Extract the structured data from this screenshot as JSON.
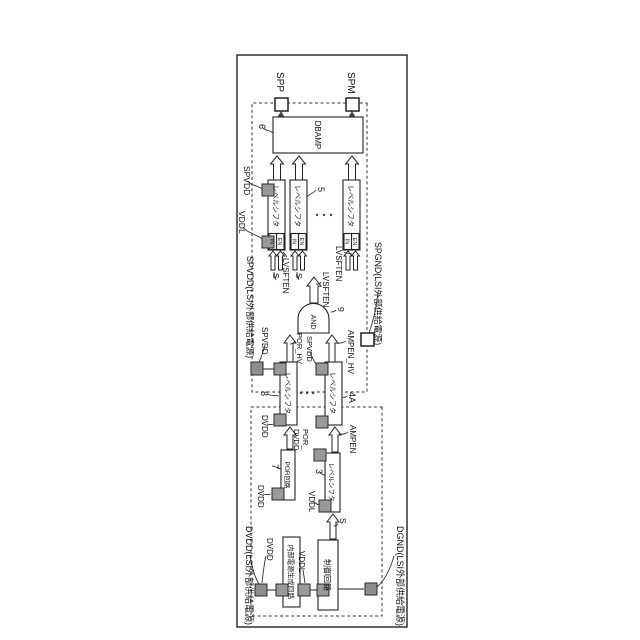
{
  "figure": {
    "outputs": {
      "spp": "SPP",
      "spm": "SPM"
    },
    "blocks": {
      "dbamp": "DBAMP",
      "level_shifter": "レベルシフタ",
      "and_gate": "AND",
      "control_circuit": "制御回路",
      "internal_power_circuit": "内部電源生成回路",
      "por_circuit": "POR回路",
      "in_pin": "IN",
      "en_pin": "EN"
    },
    "signals": {
      "s": "S",
      "lvsften": "LVSFTEN",
      "ampen": "AMPEN",
      "ampen_hv": "AMPEN_HV",
      "por_hv": "POR_HV",
      "por_dvdd_line1": "POR_",
      "por_dvdd_line2": "DVDD"
    },
    "rails": {
      "spvdd": "SPVDD",
      "vddl": "VDDL",
      "dvdd": "DVDD",
      "spvdd_ext": "SPVDD(LSI外部供給電源)",
      "spgnd_ext": "SPGND(LSI外部供給電源)",
      "dvdd_ext": "DVDD(LSI外部供給電源)",
      "dgnd_ext": "DGND(LSI外部供給電源)"
    },
    "refs": {
      "n3": "3",
      "n4a": "4A",
      "n5": "5",
      "n6": "6",
      "n7": "7",
      "n8": "8",
      "n9": "9"
    }
  }
}
